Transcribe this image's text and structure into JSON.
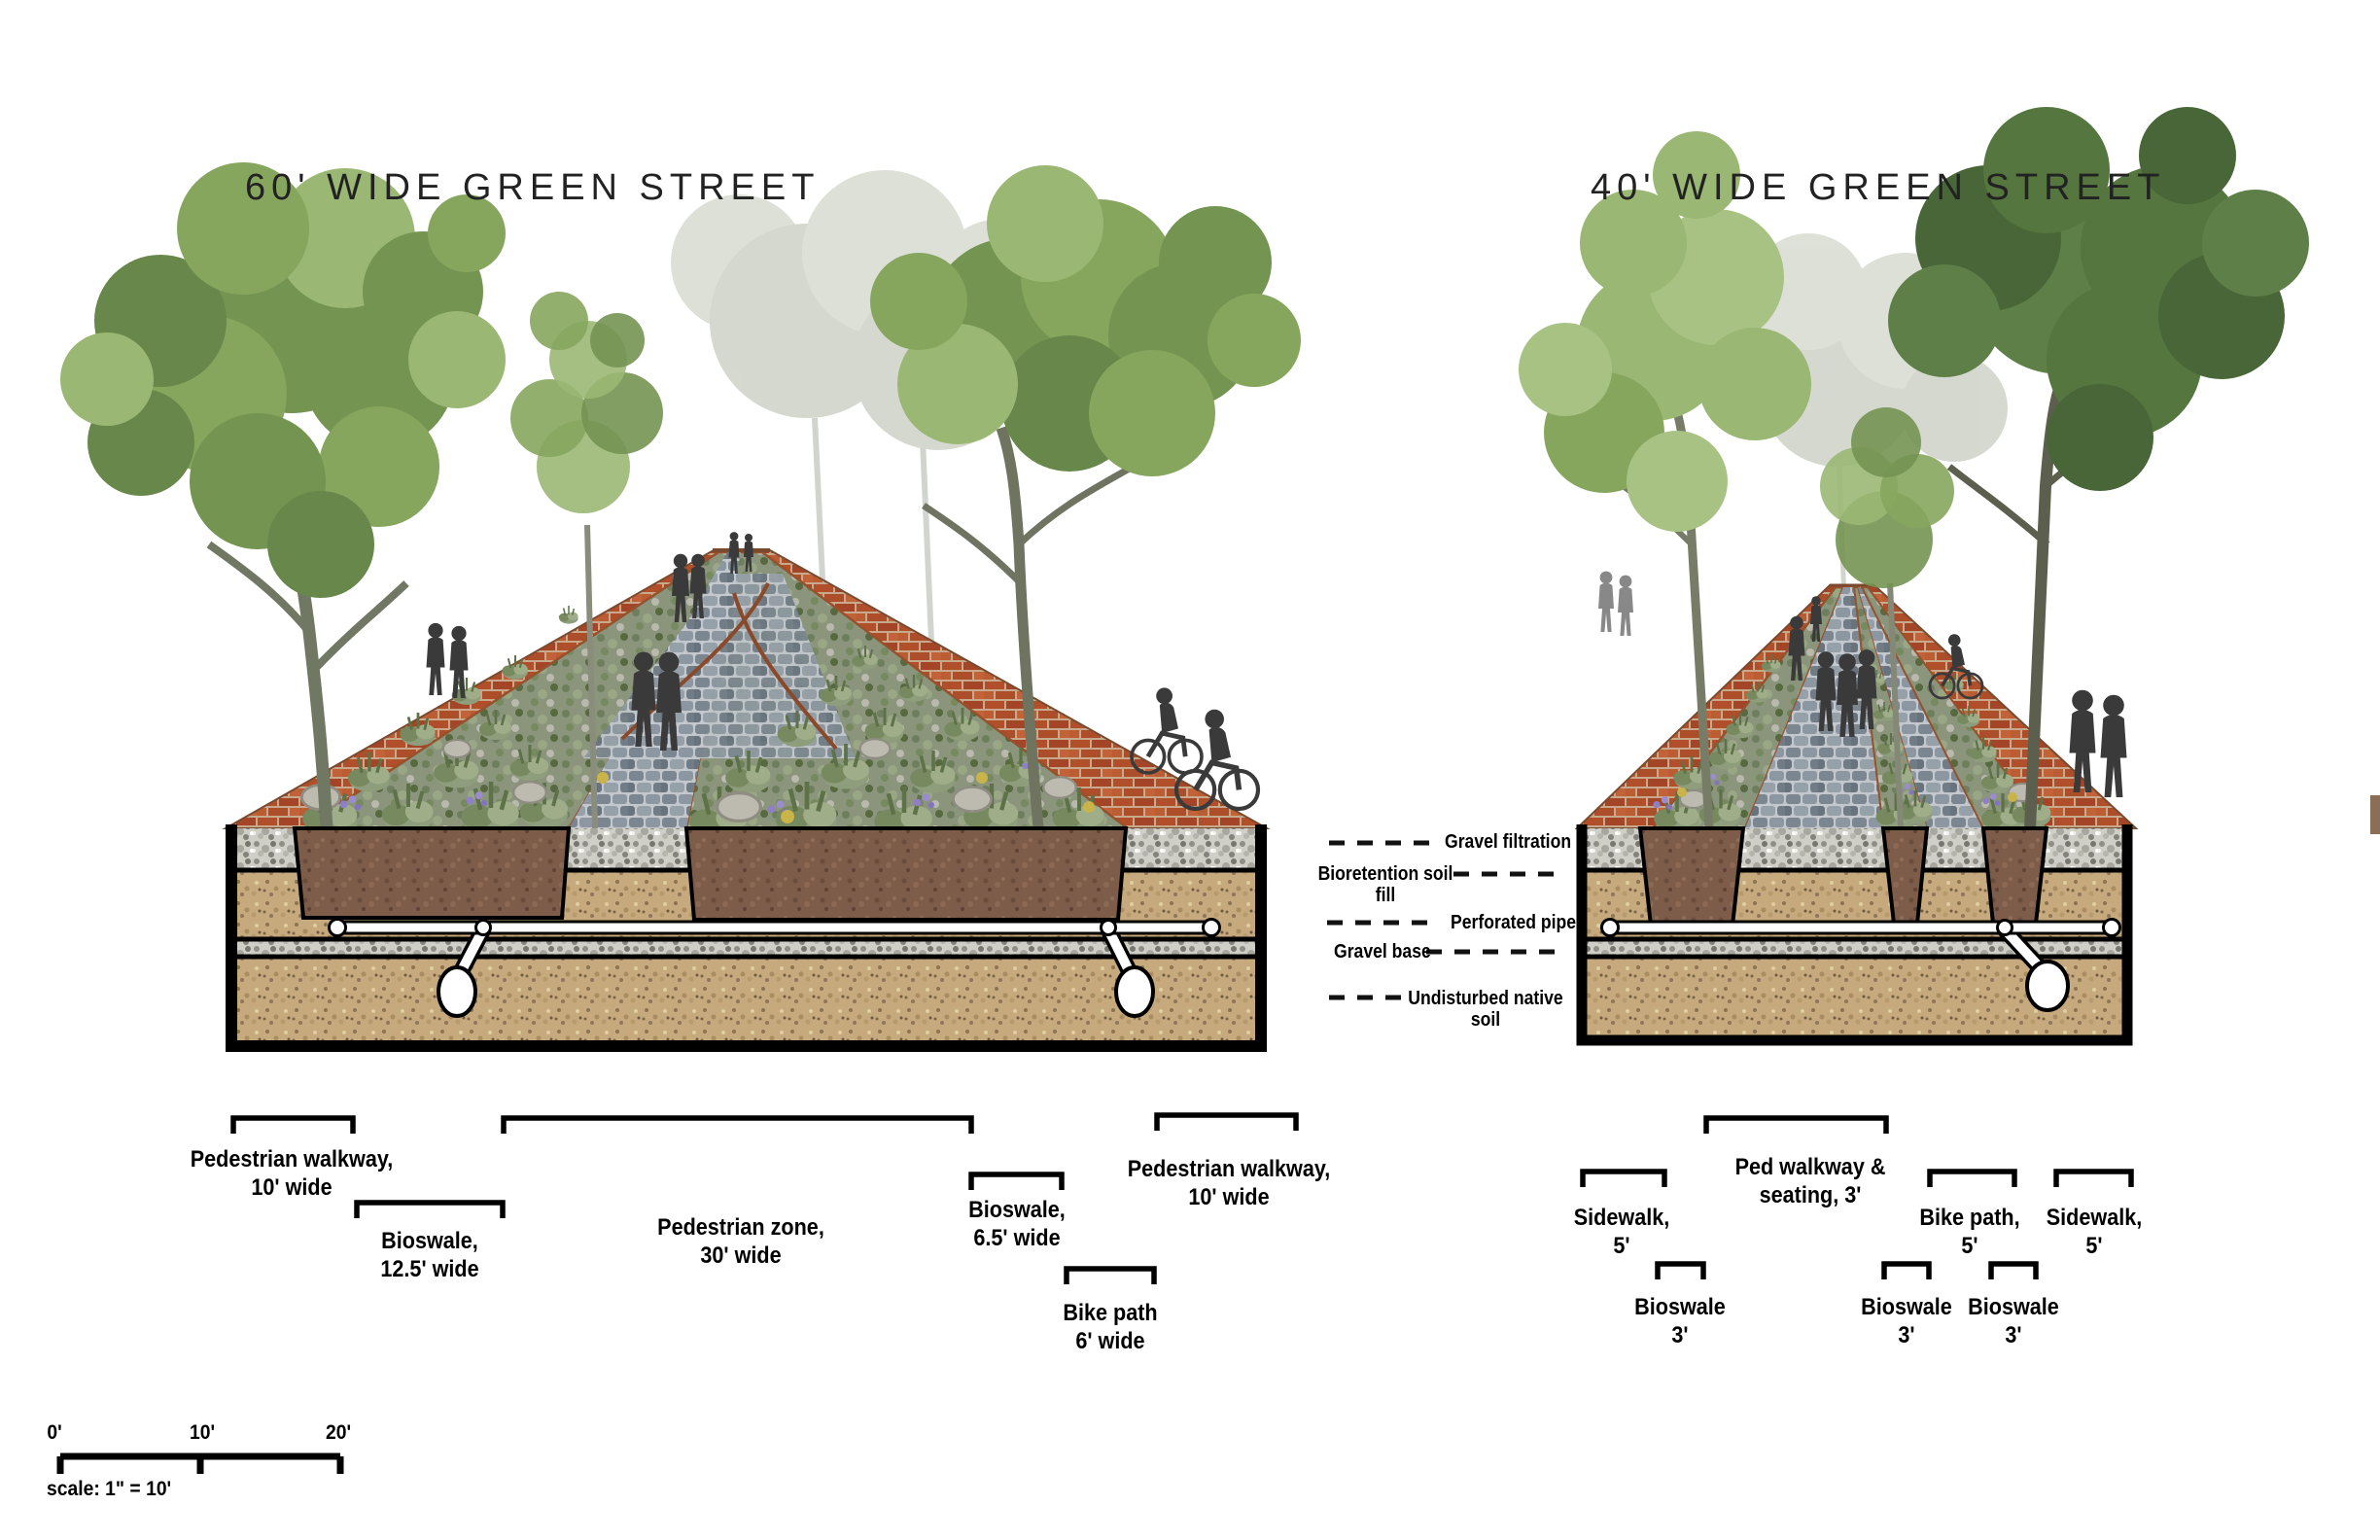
{
  "titles": {
    "street60": "60' WIDE GREEN STREET",
    "street40": "40' WIDE GREEN STREET"
  },
  "legend": [
    {
      "text": "Gravel filtration"
    },
    {
      "line1": "Bioretention soil",
      "line2": "fill"
    },
    {
      "text": "Perforated pipe"
    },
    {
      "text": "Gravel base"
    },
    {
      "line1": "Undisturbed native",
      "line2": "soil"
    }
  ],
  "dims60": [
    {
      "line1": "Pedestrian walkway,",
      "line2": "10' wide"
    },
    {
      "line1": "Bioswale,",
      "line2": "12.5' wide"
    },
    {
      "line1": "Pedestrian zone,",
      "line2": "30' wide"
    },
    {
      "line1": "Bioswale,",
      "line2": "6.5' wide"
    },
    {
      "line1": "Bike path",
      "line2": "6' wide"
    },
    {
      "line1": "Pedestrian walkway,",
      "line2": "10' wide"
    }
  ],
  "dims40": [
    {
      "line1": "Sidewalk,",
      "line2": "5'"
    },
    {
      "line1": "Ped walkway &",
      "line2": "seating, 3'"
    },
    {
      "line1": "Bioswale",
      "line2": "3'"
    },
    {
      "line1": "Bioswale",
      "line2": "3'"
    },
    {
      "line1": "Bike path,",
      "line2": "5'"
    },
    {
      "line1": "Bioswale",
      "line2": "3'"
    },
    {
      "line1": "Sidewalk,",
      "line2": "5'"
    }
  ],
  "scalebar": {
    "tick0": "0'",
    "tick1": "10'",
    "tick2": "20'",
    "caption": "scale: 1\" = 10'"
  },
  "palette": {
    "brick": "#b0512c",
    "cobble": "#7b8690",
    "soil": "#c6a97c",
    "bioretention_fill": "#7d5c49",
    "gravel": "#cfcfc8",
    "foliage": "#749452",
    "silhouette": "#3a3a3a",
    "line": "#000000"
  }
}
